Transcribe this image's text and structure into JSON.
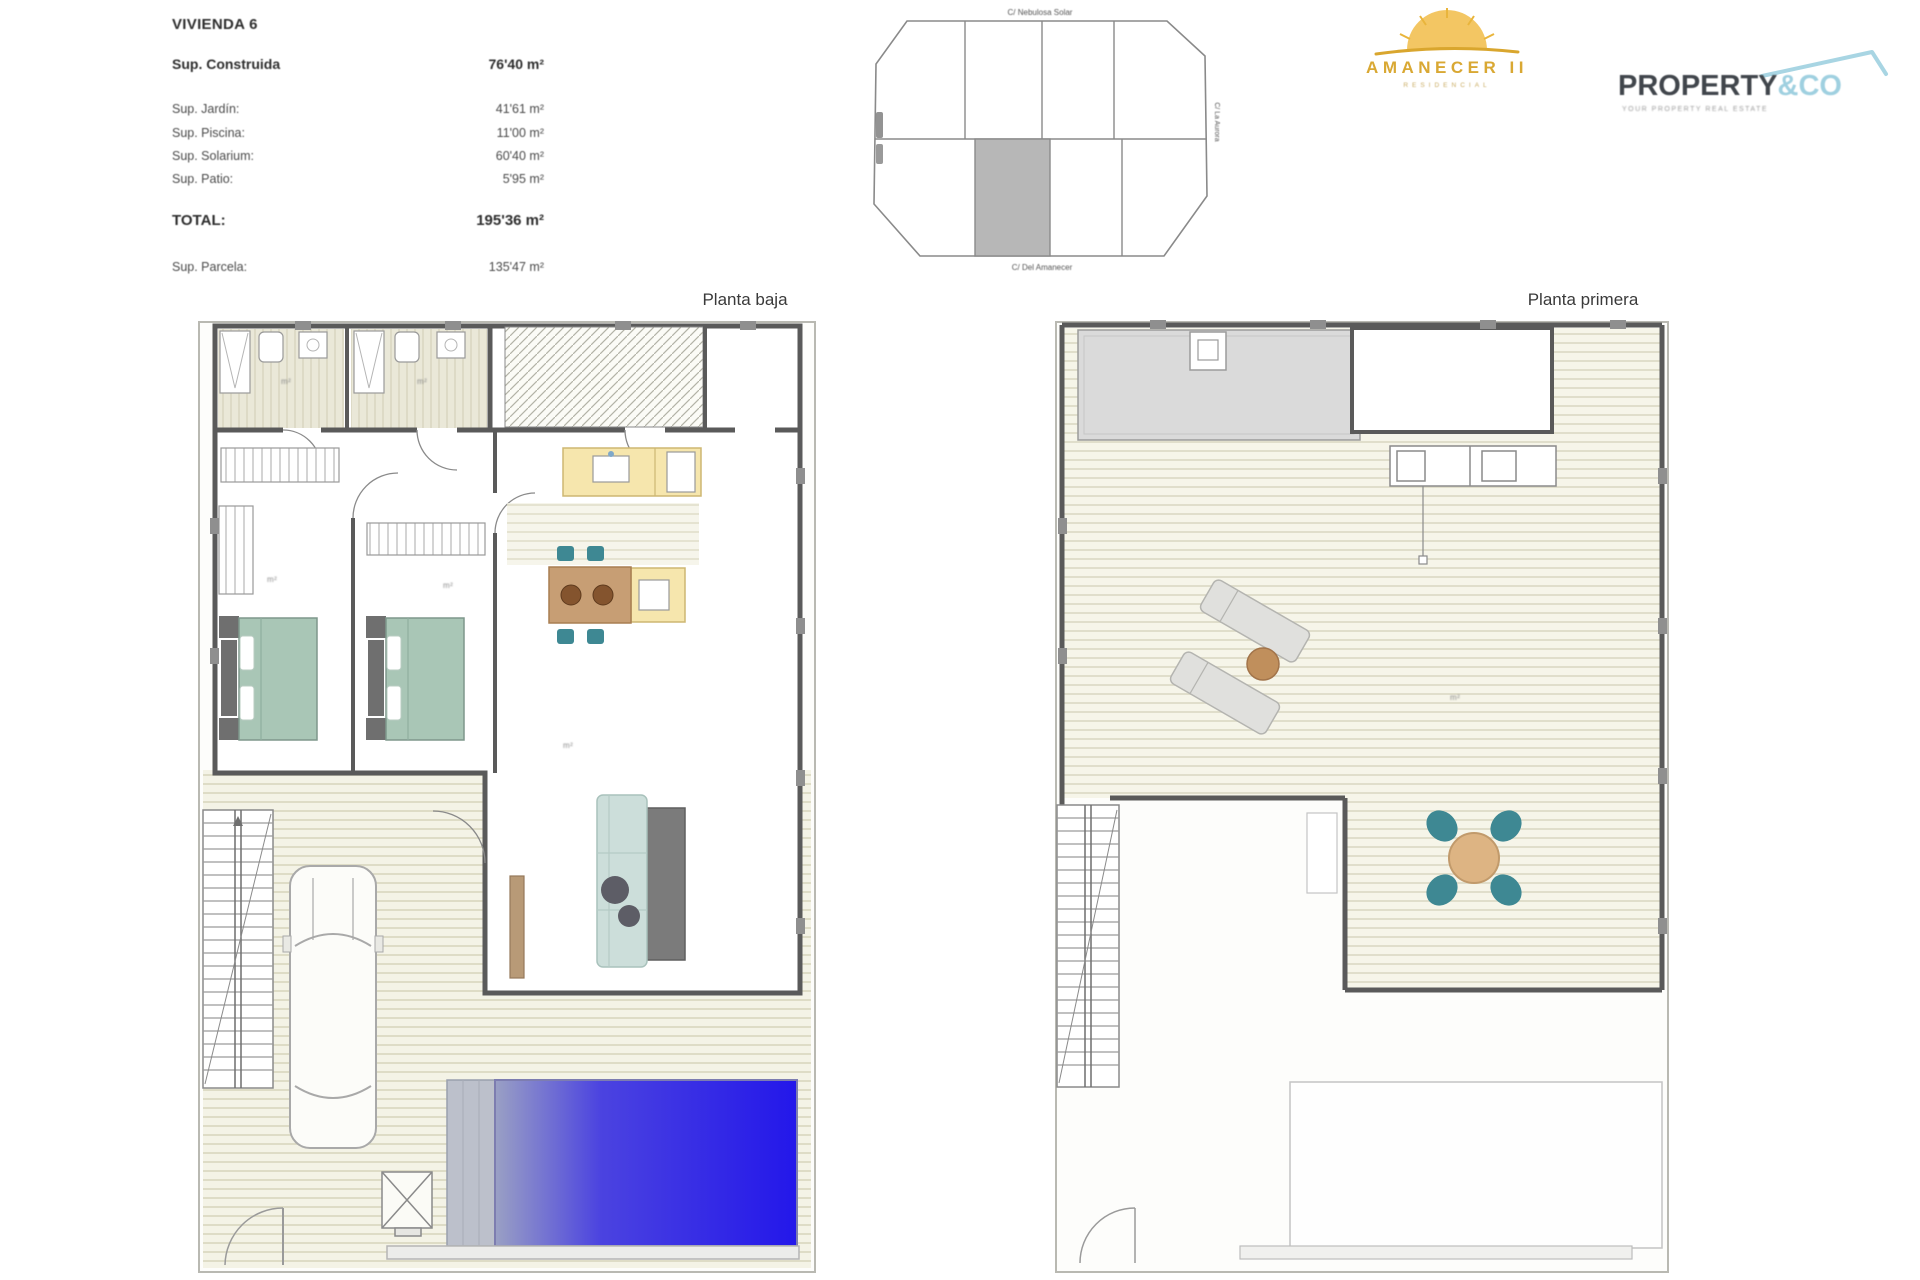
{
  "summary": {
    "title": "VIVIENDA 6",
    "construida_label": "Sup. Construida",
    "construida_value": "76'40 m²",
    "jardin_label": "Sup. Jardín:",
    "jardin_value": "41'61 m²",
    "piscina_label": "Sup. Piscina:",
    "piscina_value": "11'00 m²",
    "solarium_label": "Sup. Solarium:",
    "solarium_value": "60'40 m²",
    "patio_label": "Sup. Patio:",
    "patio_value": "5'95 m²",
    "total_label": "TOTAL:",
    "total_value": "195'36 m²",
    "parcela_label": "Sup. Parcela:",
    "parcela_value": "135'47 m²"
  },
  "site_plan": {
    "street_top": "C/ Nebulosa Solar",
    "street_bottom": "C/ Del Amanecer",
    "street_right": "C/ La Aurora",
    "selected_plot_color": "#b7b7b7"
  },
  "plans": {
    "ground_title": "Planta baja",
    "first_title": "Planta primera",
    "area_label": "m²"
  },
  "logos": {
    "amanecer_name": "AMANECER II",
    "amanecer_subtitle": "RESIDENCIAL",
    "amanecer_gold": "#d9a833",
    "property_name": "PROPERTY",
    "property_suffix": "&CO",
    "property_accent": "#9fd0e0",
    "property_dark": "#41464c",
    "property_tagline": "YOUR PROPERTY REAL ESTATE"
  },
  "palette": {
    "wall": "#5a5a5a",
    "bed": "#a9c6b6",
    "chair": "#3e8893",
    "counter": "#f6e6ad",
    "table": "#c79e74",
    "sofa": "#ccdeda",
    "pool_start": "#9aa0c4",
    "pool_end": "#2317ea",
    "deck_line": "#dedcc6"
  }
}
